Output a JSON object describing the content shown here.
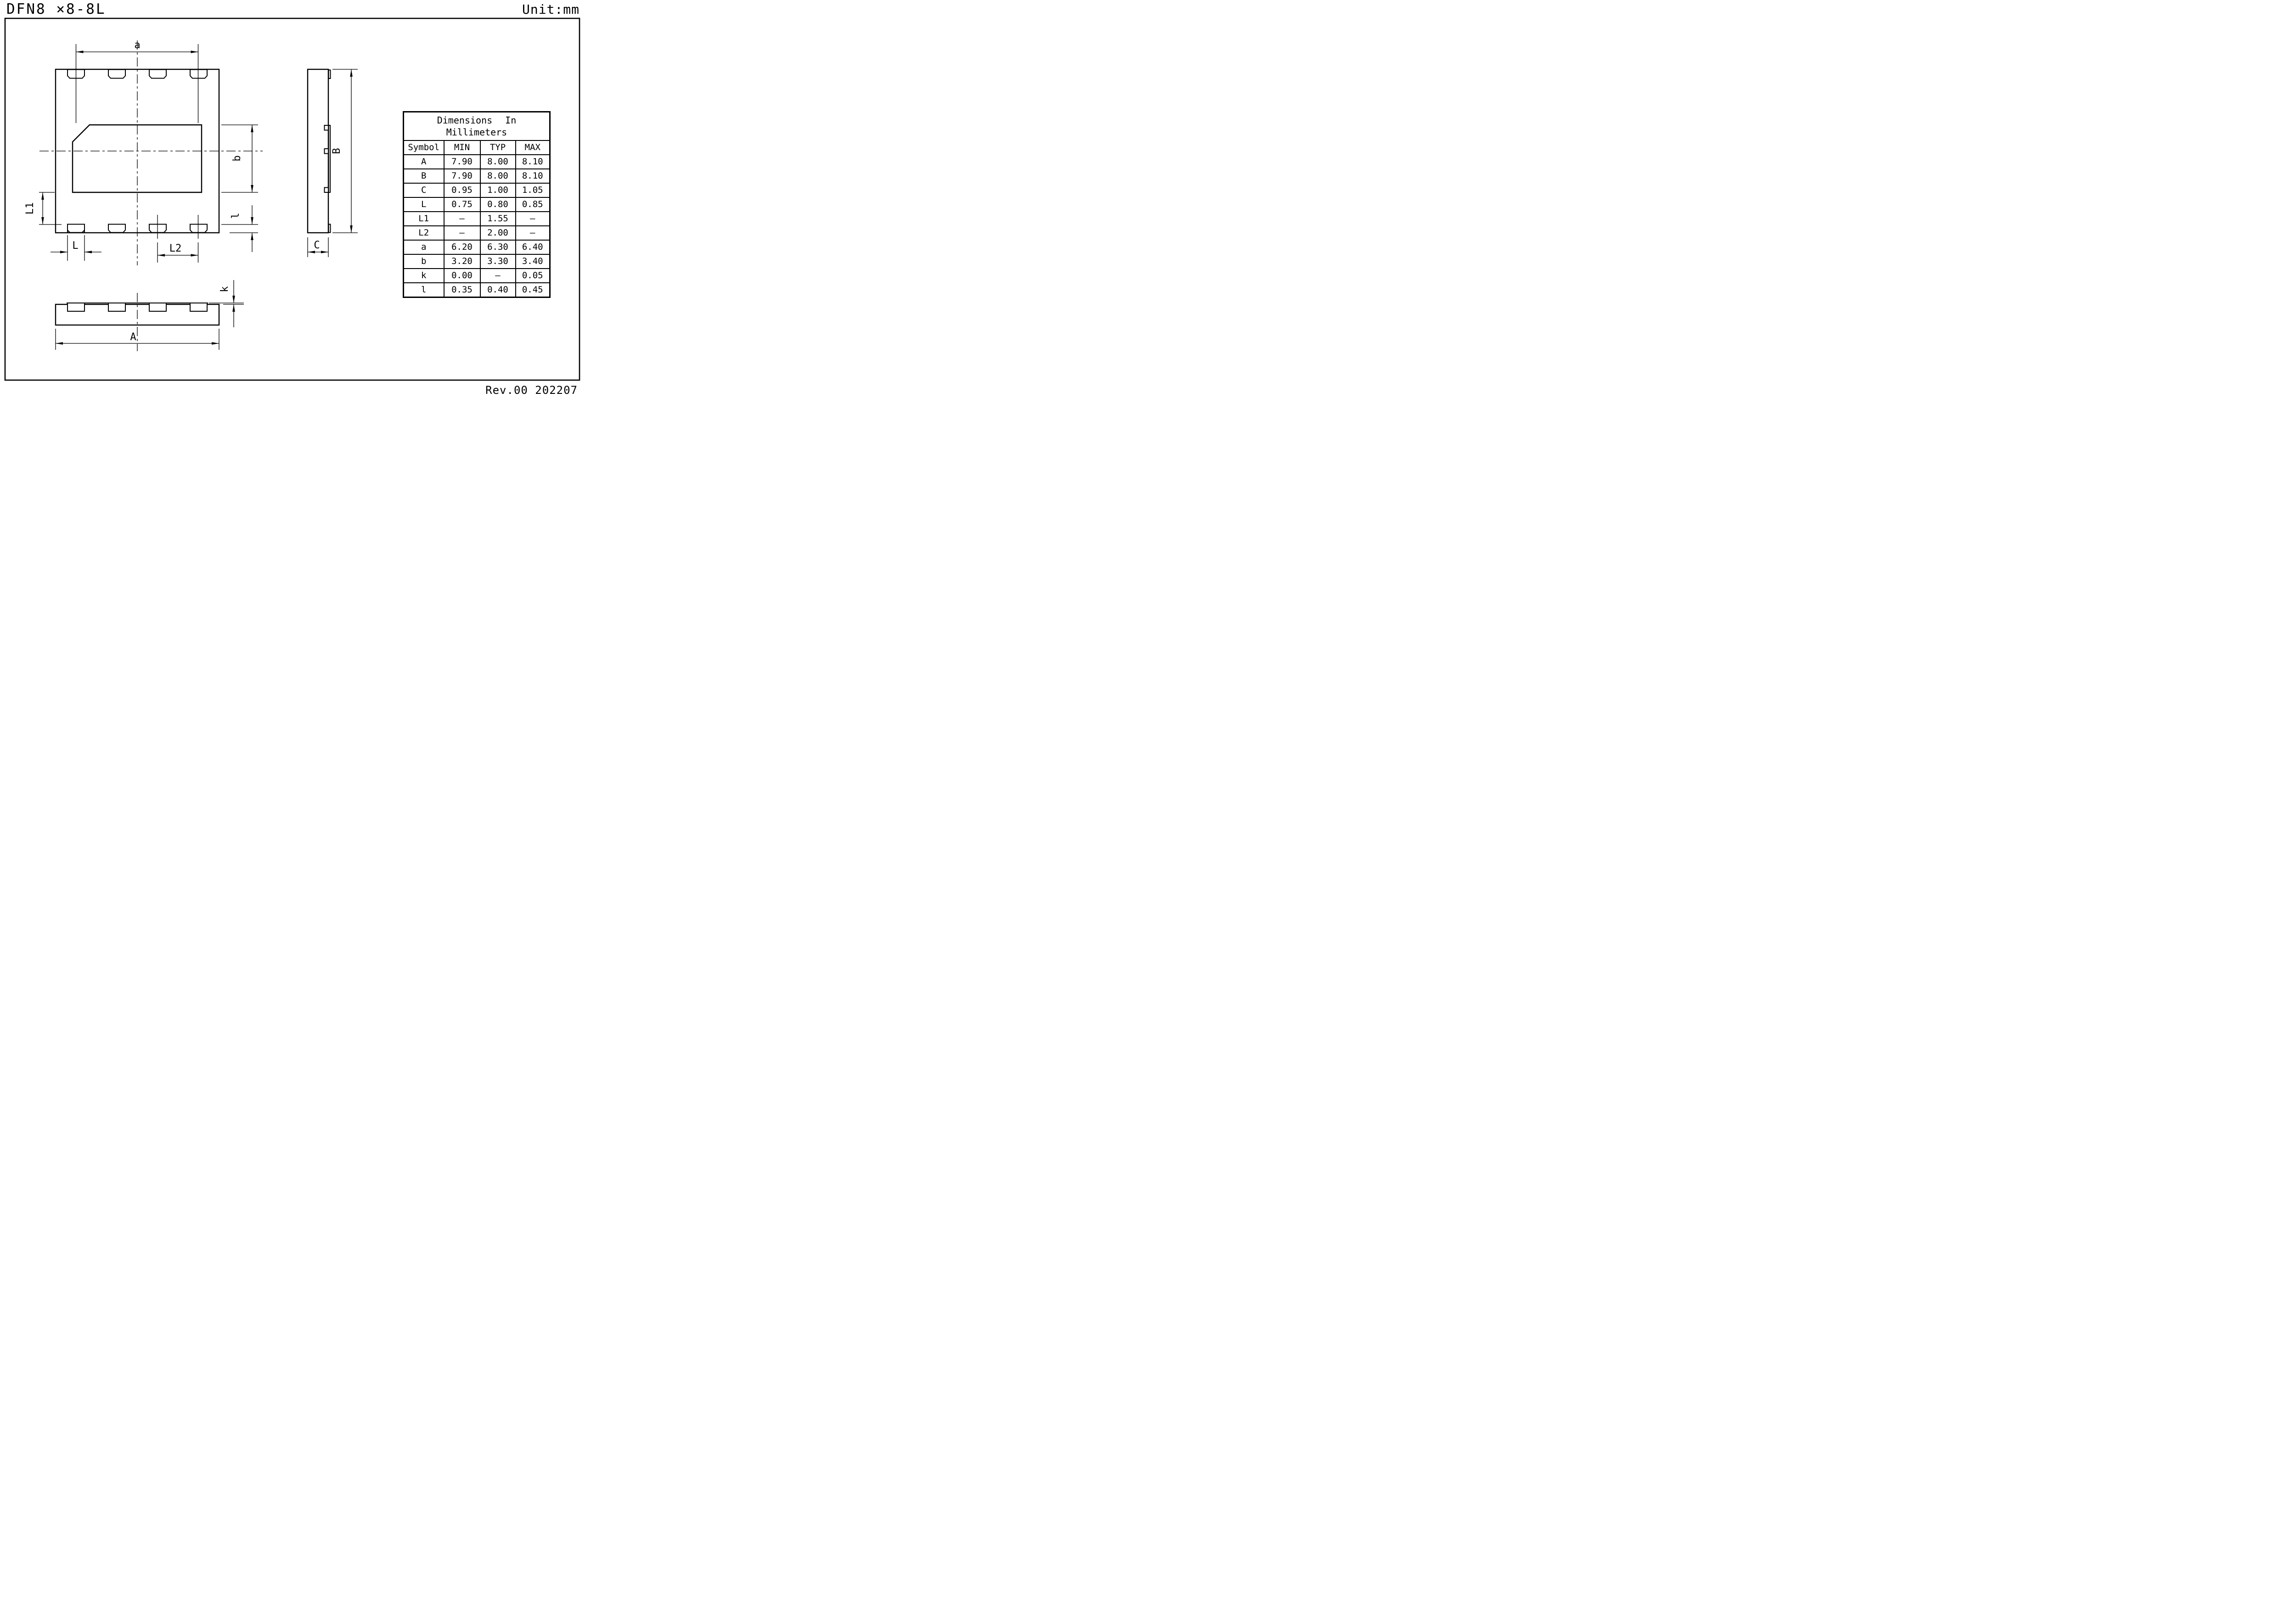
{
  "page": {
    "title": "DFN8 ×8-8L",
    "unit_label": "Unit:mm",
    "revision": "Rev.00 202207"
  },
  "dimension_labels": {
    "a": "a",
    "b": "b",
    "l": "l",
    "L": "L",
    "L1": "L1",
    "L2": "L2",
    "A": "A",
    "B": "B",
    "C": "C",
    "k": "k"
  },
  "table": {
    "title_line1": "Dimensions In",
    "title_line2": "Millimeters",
    "headers": [
      "Symbol",
      "MIN",
      "TYP",
      "MAX"
    ],
    "rows": [
      {
        "symbol": "A",
        "min": "7.90",
        "typ": "8.00",
        "max": "8.10"
      },
      {
        "symbol": "B",
        "min": "7.90",
        "typ": "8.00",
        "max": "8.10"
      },
      {
        "symbol": "C",
        "min": "0.95",
        "typ": "1.00",
        "max": "1.05"
      },
      {
        "symbol": "L",
        "min": "0.75",
        "typ": "0.80",
        "max": "0.85"
      },
      {
        "symbol": "L1",
        "min": "–",
        "typ": "1.55",
        "max": "–"
      },
      {
        "symbol": "L2",
        "min": "–",
        "typ": "2.00",
        "max": "–"
      },
      {
        "symbol": "a",
        "min": "6.20",
        "typ": "6.30",
        "max": "6.40"
      },
      {
        "symbol": "b",
        "min": "3.20",
        "typ": "3.30",
        "max": "3.40"
      },
      {
        "symbol": "k",
        "min": "0.00",
        "typ": "–",
        "max": "0.05"
      },
      {
        "symbol": "l",
        "min": "0.35",
        "typ": "0.40",
        "max": "0.45"
      }
    ]
  },
  "colors": {
    "ink": "#000000",
    "paper": "#ffffff"
  }
}
